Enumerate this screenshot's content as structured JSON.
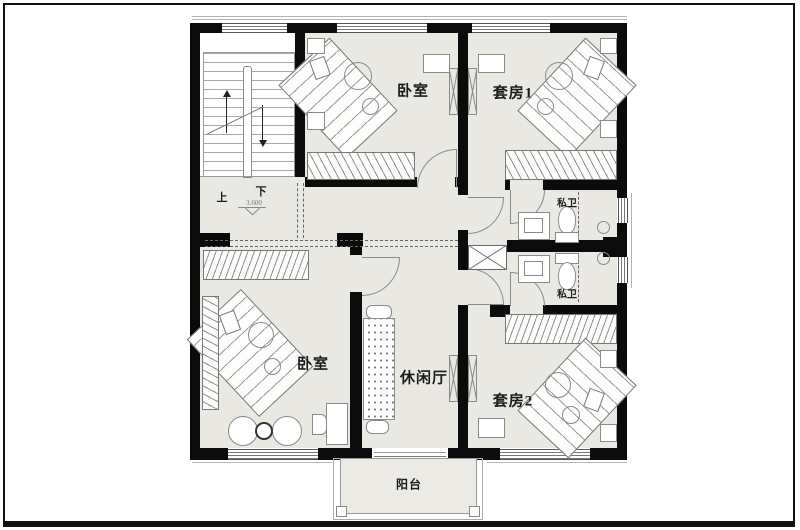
{
  "rooms": {
    "bedroom_top": "卧室",
    "suite1": "套房1",
    "bath1": "私卫",
    "bath2": "私卫",
    "bedroom_bottom": "卧室",
    "lounge": "休闲厅",
    "suite2": "套房2",
    "balcony": "阳台"
  },
  "stairs": {
    "up": "上",
    "down": "下",
    "elevation": "3.600"
  },
  "colors": {
    "floor": "#e9e8e2",
    "wall": "#0b0b0b",
    "furniture_line": "#8a8a8a"
  }
}
